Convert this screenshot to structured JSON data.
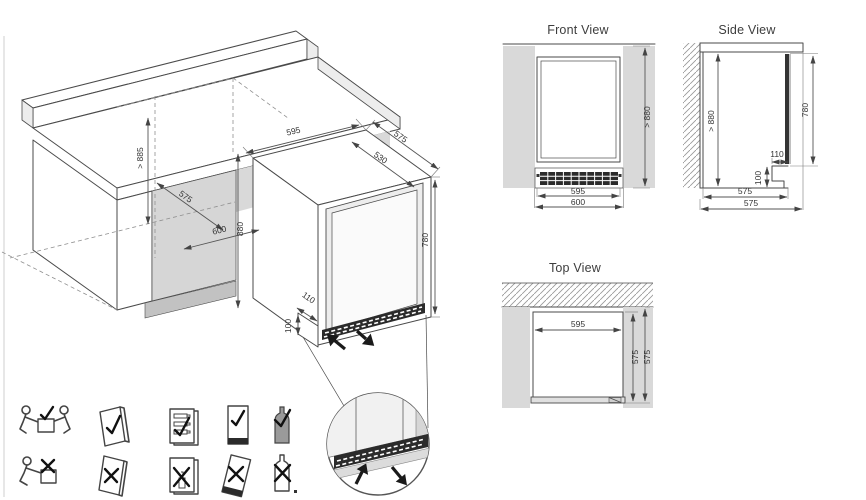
{
  "colors": {
    "line": "#4a4a4a",
    "dim": "#555555",
    "text": "#3d3d3d",
    "panel": "#d9d9d9",
    "panel_dark": "#c2c2c2",
    "grille": "#2b2b2b",
    "hatch": "#9a9a9a"
  },
  "iso": {
    "dims": {
      "niche_height": "> 885",
      "niche_depth": "575",
      "niche_width": "600",
      "niche_front_height": "880",
      "unit_width": "595",
      "inner_width": "530",
      "unit_depth": "575",
      "door_height": "780",
      "plinth_depth": "110",
      "plinth_height": "100"
    }
  },
  "views": {
    "front": {
      "title": "Front View",
      "height": "> 880",
      "width_inner": "595",
      "width_outer": "600"
    },
    "side": {
      "title": "Side View",
      "height": "> 880",
      "door_height": "780",
      "plinth_depth": "110",
      "plinth_height": "100",
      "depth_inner": "575",
      "depth_outer": "575"
    },
    "top": {
      "title": "Top View",
      "width": "595",
      "depth_inner": "575",
      "depth_outer": "575"
    }
  },
  "pictograms": {
    "do": [
      {
        "icon": "two-person-lift-icon",
        "mark": "check"
      },
      {
        "icon": "read-manual-icon",
        "mark": "check"
      },
      {
        "icon": "bottles-lying-flat-icon",
        "mark": "check"
      },
      {
        "icon": "keep-upright-icon",
        "mark": "check"
      },
      {
        "icon": "bottle-ok-icon",
        "mark": "check"
      }
    ],
    "dont": [
      {
        "icon": "one-person-lift-icon",
        "mark": "cross"
      },
      {
        "icon": "manual-crossed-icon",
        "mark": "cross"
      },
      {
        "icon": "bottle-standing-icon",
        "mark": "cross"
      },
      {
        "icon": "do-not-tilt-icon",
        "mark": "cross"
      },
      {
        "icon": "bottle-crossed-icon",
        "mark": "cross"
      }
    ]
  }
}
